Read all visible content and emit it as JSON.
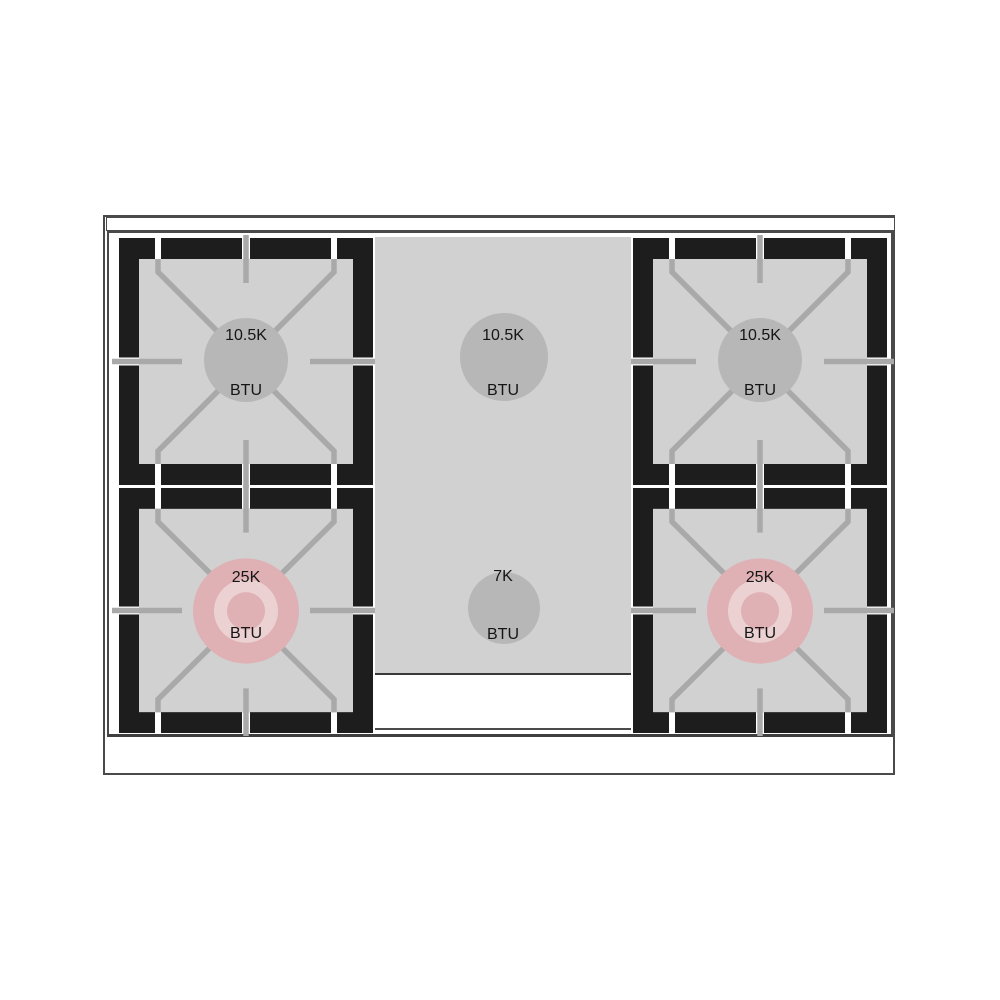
{
  "diagram": {
    "type": "gas-range-cooktop-top-view",
    "burner_count": 5
  },
  "burners": {
    "top_left": {
      "value": "10.5K",
      "unit": "BTU",
      "cap_style": "standard-gray"
    },
    "top_center": {
      "value": "10.5K",
      "unit": "BTU",
      "cap_style": "standard-gray"
    },
    "top_right": {
      "value": "10.5K",
      "unit": "BTU",
      "cap_style": "standard-gray"
    },
    "bottom_left": {
      "value": "25K",
      "unit": "BTU",
      "cap_style": "dual-ring-pink"
    },
    "bottom_center": {
      "value": "7K",
      "unit": "BTU",
      "cap_style": "standard-gray"
    },
    "bottom_right": {
      "value": "25K",
      "unit": "BTU",
      "cap_style": "dual-ring-pink"
    }
  },
  "colors": {
    "grate_frame_black": "#1d1d1d",
    "surface_gray": "#d1d1d1",
    "grate_line_gray": "#a9a9a9",
    "burner_cap_gray": "#b7b7b7",
    "burner_cap_pink": "#dfb0b4",
    "burner_cap_pink_ring": "#ecd1d3",
    "outline_gray": "#4a4a4a",
    "text_black": "#151515"
  }
}
